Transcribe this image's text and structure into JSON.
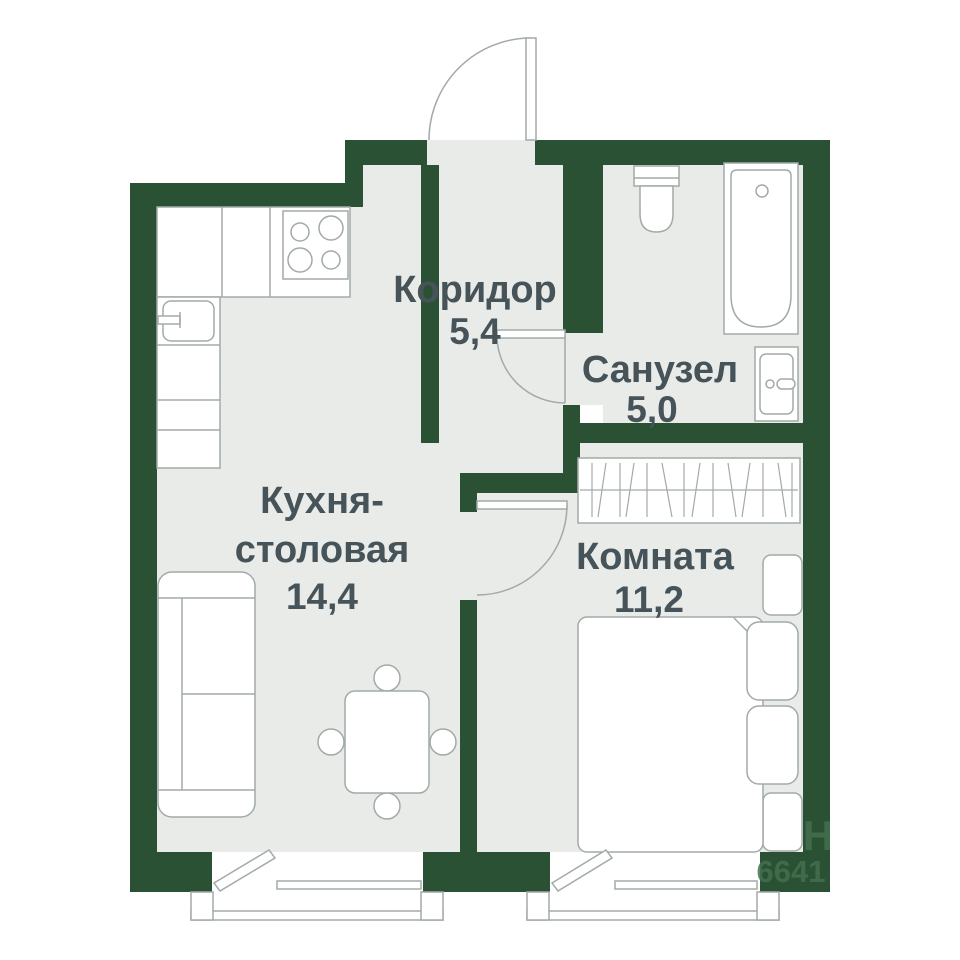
{
  "rooms": {
    "corridor": {
      "name": "Коридор",
      "area": "5,4"
    },
    "bathroom": {
      "name": "Санузел",
      "area": "5,0"
    },
    "kitchen": {
      "name_line1": "Кухня-",
      "name_line2": "столовая",
      "area": "14,4"
    },
    "bedroom": {
      "name": "Комната",
      "area": "11,2"
    }
  },
  "watermark": {
    "letter": "Н",
    "digits": "6641"
  },
  "colors": {
    "wall": "#2b5134",
    "floor": "#e9ebe9",
    "furniture_stroke": "#a2aaa8",
    "label_text": "#465359",
    "watermark_text": "#44704f",
    "background": "#ffffff"
  }
}
